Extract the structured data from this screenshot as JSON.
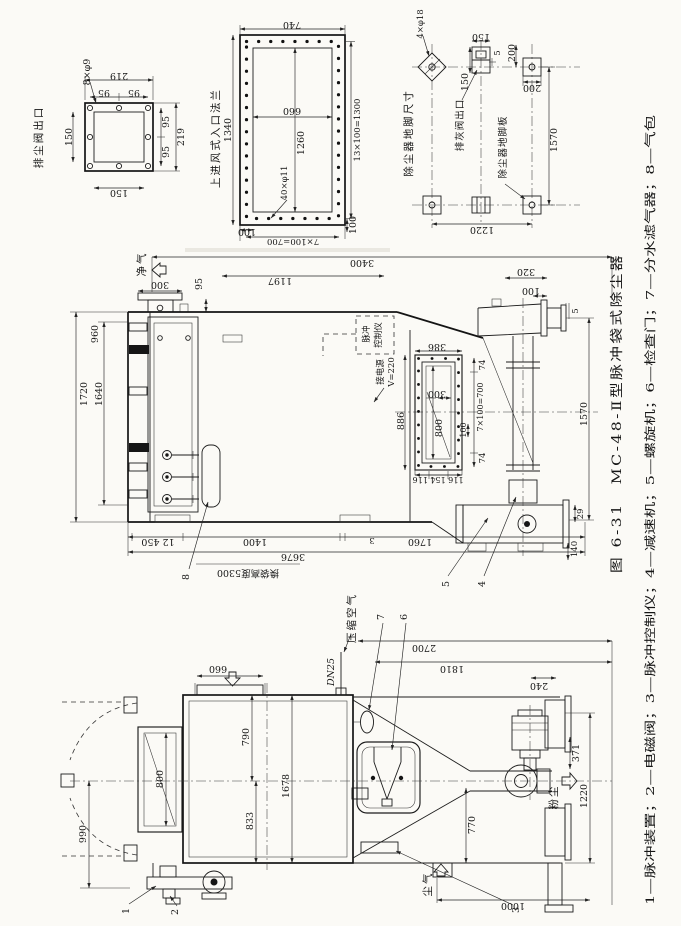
{
  "figure": {
    "caption": "图 6-31　MC-48-Ⅱ型脉冲袋式除尘器",
    "legend": "1—脉冲装置；2—电磁阀；3—脉冲控制仪；4—减速机；5—螺旋机；6—检查门；7—分水滤气器；8—气包"
  },
  "views": {
    "dust_valve_outlet": {
      "title": "排尘阀出口",
      "bolts": "8×φ9",
      "dims": {
        "w219": "219",
        "p95a": "95",
        "p95b": "95",
        "h150": "150",
        "p95c": "95",
        "p95d": "95",
        "h219": "219",
        "w150": "150"
      }
    },
    "inlet_flange": {
      "title": "上进风式入口法兰",
      "bolts": "40×φ11",
      "dims": {
        "w740": "740",
        "h1340": "1340",
        "w660": "660",
        "h1260": "1260",
        "pitch_r": "13×100=1300",
        "m100a": "100",
        "pitch_b": "7×100=700",
        "m100b": "100"
      }
    },
    "foundation": {
      "title": "除尘器地脚尺寸",
      "bolts": "4×φ18",
      "ash_outlet": "排灰阀出口",
      "foot_plate": "除尘器地脚板",
      "dims": {
        "d150a": "150",
        "d5": "5",
        "d200a": "200",
        "d150b": "150",
        "d200b": "200",
        "l1570": "1570",
        "w1220": "1220"
      }
    },
    "side": {
      "clean_air": "净气",
      "pulse_ctrl1": "脉冲",
      "pulse_ctrl2": "控制仪",
      "power1": "接电源",
      "power2": "V=220",
      "note5300": "换袋高度5300",
      "leaders": {
        "p8": "8",
        "p5": "5",
        "p4": "4"
      },
      "dims": {
        "d300": "300",
        "d95": "95",
        "d3400": "3400",
        "d1197": "1197",
        "d320": "320",
        "d100a": "100",
        "d5": "5",
        "d386": "386",
        "d74a": "74",
        "pitch": "7×100=700",
        "d100b": "100",
        "d74b": "74",
        "d300b": "300",
        "d800": "800",
        "d886": "886",
        "chain": "116 154 116",
        "d1720": "1720",
        "d1640": "1640",
        "d960": "960",
        "d1570": "1570",
        "d29": "29",
        "d140": "140",
        "d1760": "1760",
        "d3": "3",
        "d1400": "1400",
        "d12_450": "12 450",
        "d3676": "3676"
      }
    },
    "end": {
      "compressed_air": "压缩空气",
      "pipe": "DN25",
      "dust_out": "粉尘",
      "dirty_air": "尘气",
      "leaders": {
        "p1": "1",
        "p2": "2",
        "p3": "3",
        "p6": "6",
        "p7": "7"
      },
      "dims": {
        "d660": "660",
        "d790": "790",
        "d1678": "1678",
        "d833": "833",
        "d800": "800",
        "d990": "990",
        "d2700": "2700",
        "d1810": "1810",
        "d240": "240",
        "d371": "371",
        "d1220": "1220",
        "d770": "770",
        "d1000": "1000"
      }
    }
  }
}
